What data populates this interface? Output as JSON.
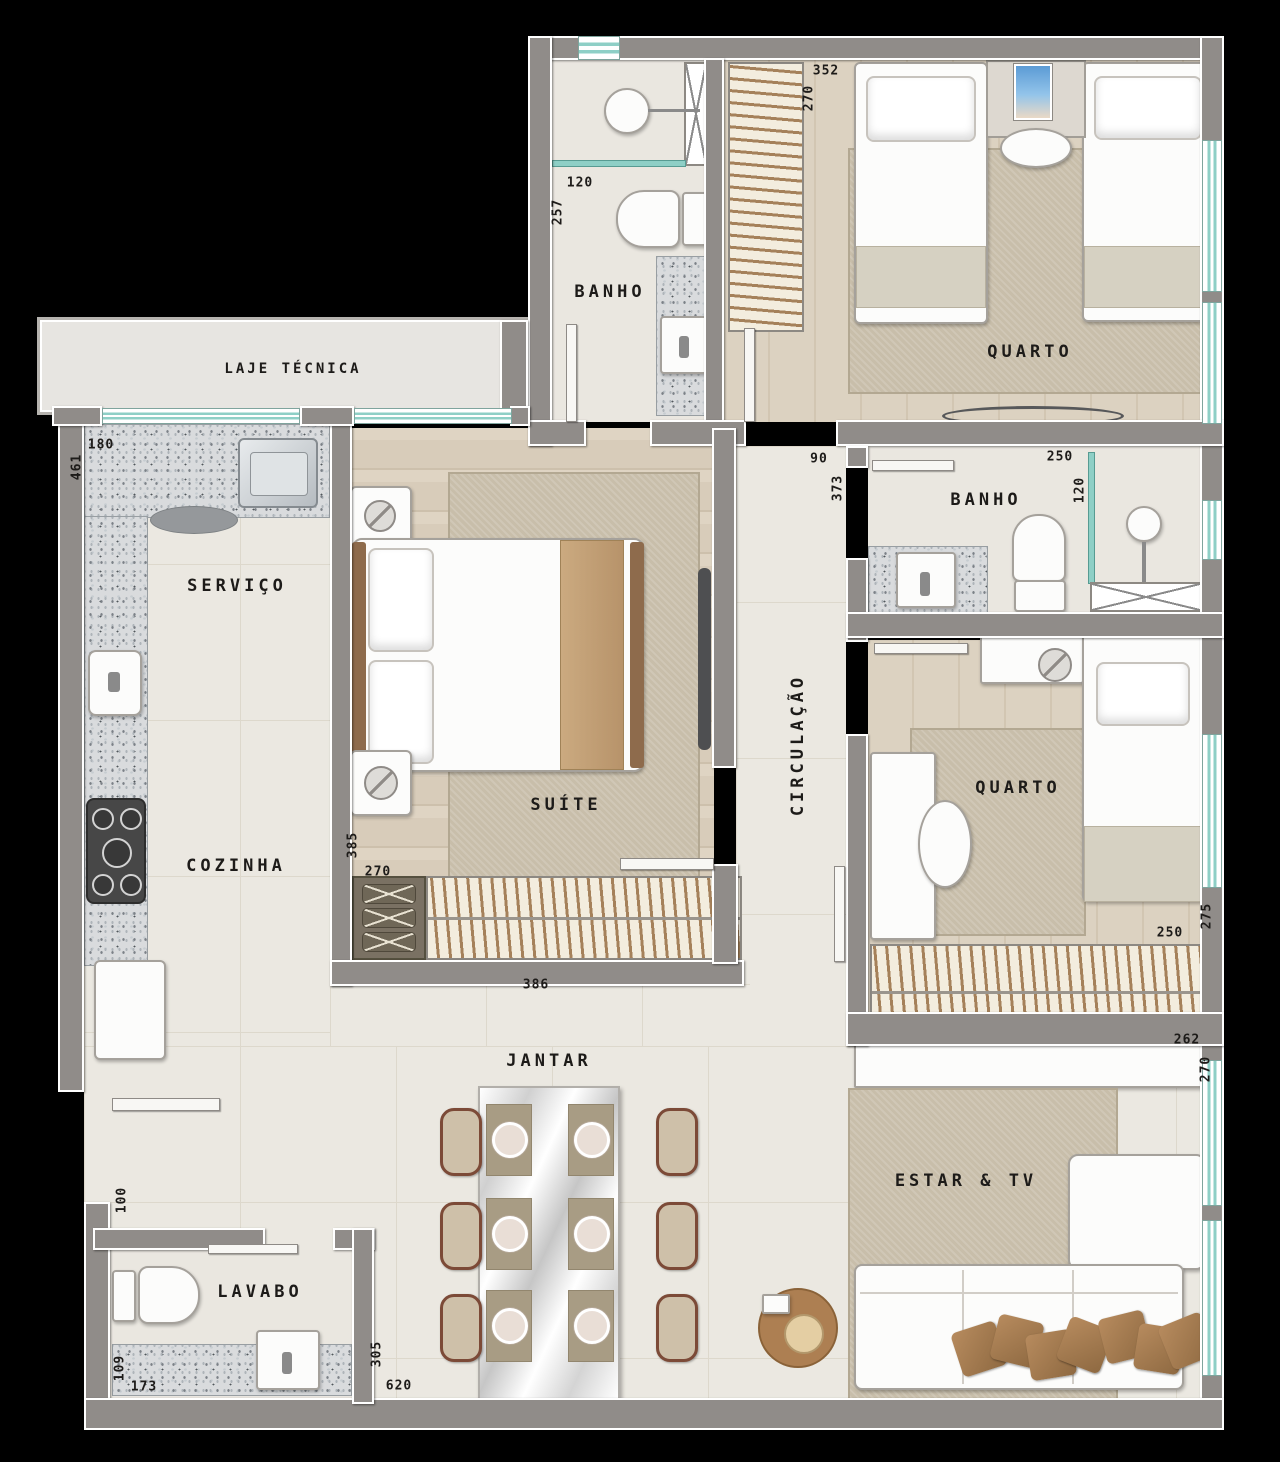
{
  "rooms": {
    "laje_tecnica": "LAJE TÉCNICA",
    "banho_suite": "BANHO",
    "quarto_casal": "QUARTO",
    "servico": "SERVIÇO",
    "cozinha": "COZINHA",
    "suite": "SUÍTE",
    "circulacao": "CIRCULAÇÃO",
    "banho_social": "BANHO",
    "quarto_solteiro": "QUARTO",
    "jantar": "JANTAR",
    "estar_tv": "ESTAR & TV",
    "lavabo": "LAVABO"
  },
  "dimensions_cm": {
    "banho_suite_width": "120",
    "banho_suite_depth": "257",
    "quarto1_width": "352",
    "quarto1_depth": "270",
    "servico_width": "180",
    "servico_depth": "461",
    "circulacao_width": "90",
    "circulacao_depth": "373",
    "banho_social_width": "250",
    "banho_social_depth": "120",
    "suite_depth": "385",
    "suite_width_a": "270",
    "suite_width_b": "386",
    "quarto2_width": "250",
    "quarto2_depth": "275",
    "estar_width": "262",
    "estar_depth": "270",
    "entrada_width": "100",
    "lavabo_depth": "109",
    "lavabo_width": "173",
    "sala_depth": "305",
    "sala_width": "620"
  },
  "colors": {
    "background": "#000000",
    "wall_fill": "#908c89",
    "wall_outline": "#ffffff",
    "floor_tile": "#ebe8e1",
    "floor_wood": "#d8ccba",
    "rug": "#c8beaa",
    "granite": "#d9dbdd",
    "window_glass": "#8ecfc6",
    "hanger_wood": "#a5815a",
    "sofa_pillow": "#a57b4e",
    "tablet_screen": "#5b9bd5",
    "label_text": "#1d1b19"
  }
}
